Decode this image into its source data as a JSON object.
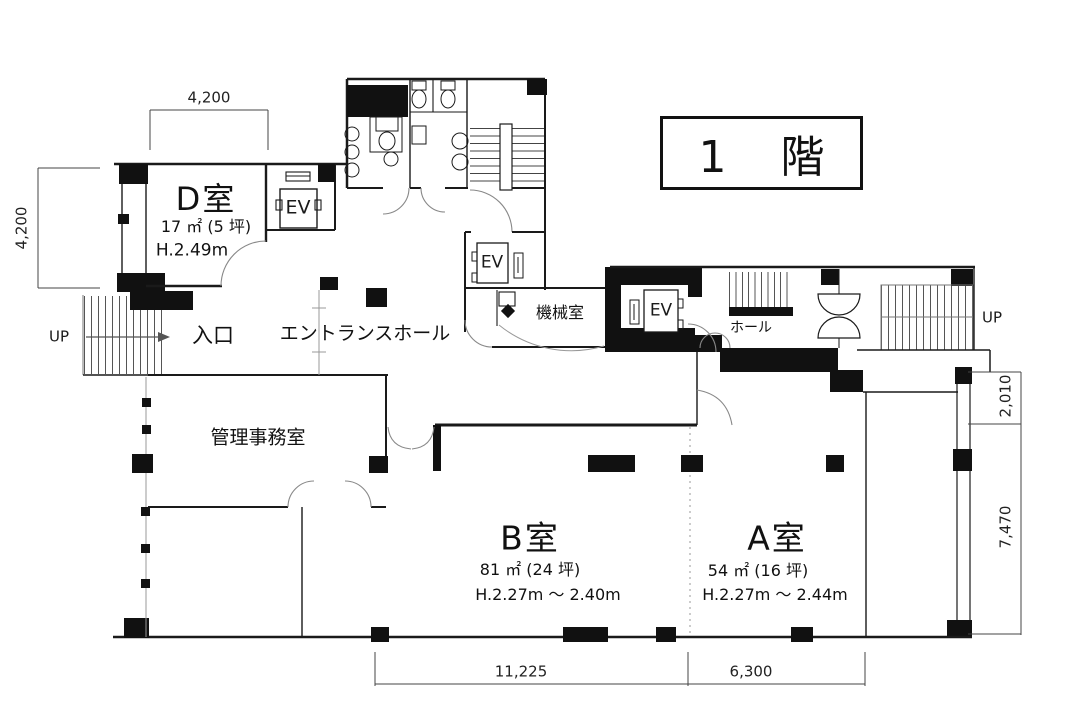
{
  "title": "1 階",
  "rooms": {
    "d": {
      "name": "D室",
      "area": "17 ㎡ (5 坪)",
      "height": "H.2.49m"
    },
    "b": {
      "name": "B室",
      "area": "81 ㎡ (24 坪)",
      "height": "H.2.27m ～ 2.40m"
    },
    "a": {
      "name": "A室",
      "area": "54 ㎡ (16 坪)",
      "height": "H.2.27m ～ 2.44m"
    }
  },
  "labels": {
    "entrance": "入口",
    "entrance_hall": "エントランスホール",
    "office": "管理事務室",
    "machine_room": "機械室",
    "hall": "ホール",
    "elevator": "EV",
    "up": "UP"
  },
  "dimensions": {
    "top_width": "4,200",
    "left_height": "4,200",
    "right_upper": "2,010",
    "right_lower": "7,470",
    "bottom_b": "11,225",
    "bottom_a": "6,300"
  },
  "colors": {
    "wall": "#1a1a1a",
    "background": "#ffffff"
  }
}
